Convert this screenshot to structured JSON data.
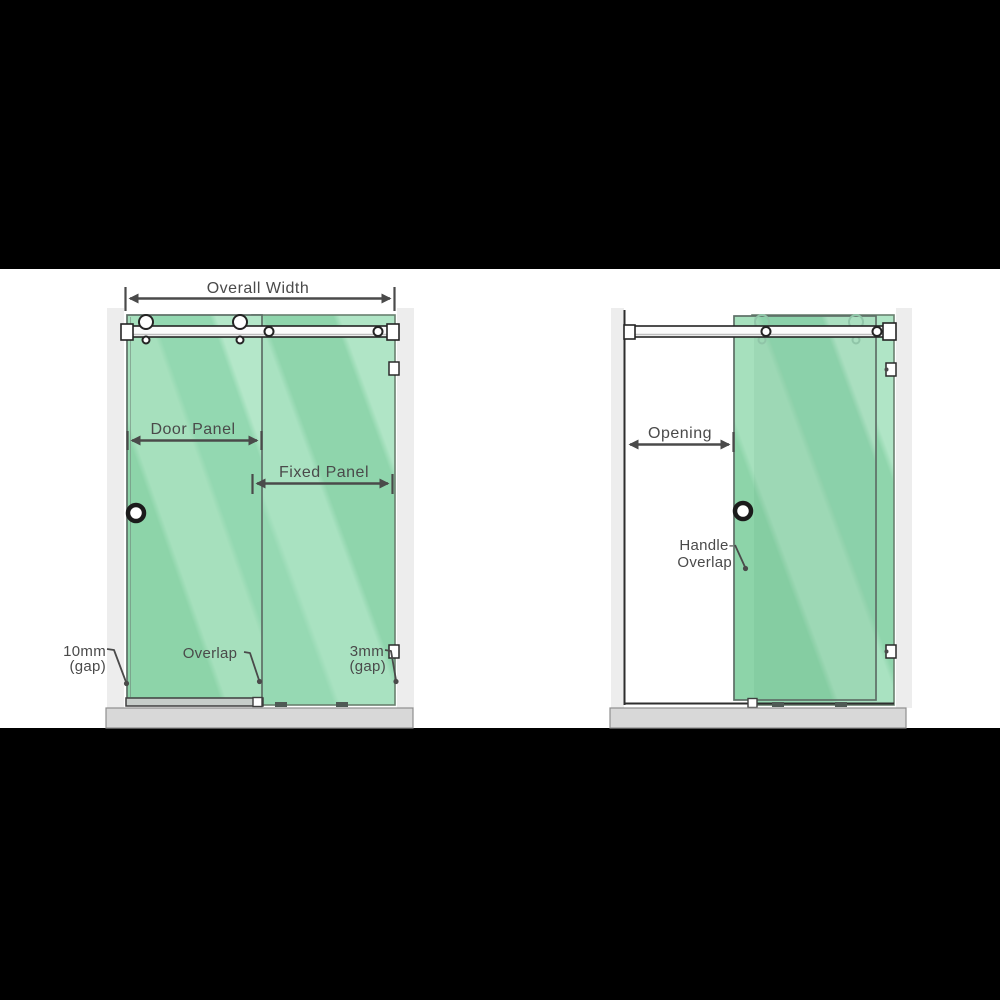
{
  "left_diagram": {
    "overall_width_label": "Overall Width",
    "door_panel_label": "Door Panel",
    "fixed_panel_label": "Fixed Panel",
    "gap_left_value": "10mm",
    "gap_left_unit": "(gap)",
    "overlap_label": "Overlap",
    "gap_right_value": "3mm",
    "gap_right_unit": "(gap)"
  },
  "right_diagram": {
    "opening_label": "Opening",
    "handle_overlap_line1": "Handle-",
    "handle_overlap_line2": "Overlap"
  },
  "colors": {
    "background": "#000000",
    "canvas": "#ffffff",
    "glass_base": "#93d8b1",
    "glass_highlight": "#b4e7c9",
    "glass_shade": "#8dd4a9",
    "dimension_gray": "#4a4a4a",
    "wall_band": "#ededed",
    "floor_gray": "#d8d8d8",
    "hardware_dark": "#242424"
  }
}
